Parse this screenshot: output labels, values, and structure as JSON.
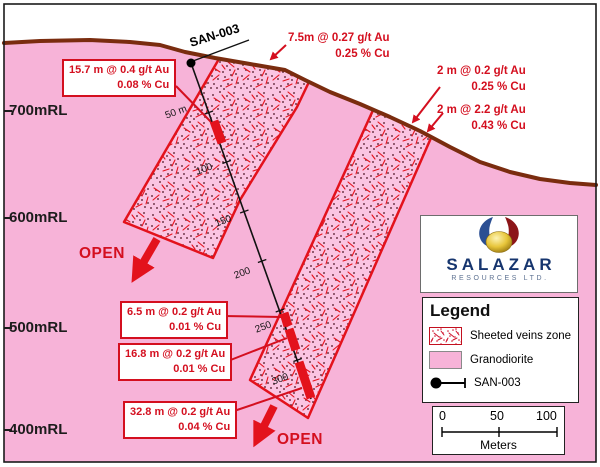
{
  "diagram": {
    "type": "geological cross-section",
    "drill_hole": {
      "name": "SAN-003"
    },
    "elevations": [
      "700mRL",
      "600mRL",
      "500mRL",
      "400mRL"
    ],
    "depth_marks": [
      "50 m",
      "100",
      "150",
      "200",
      "250",
      "300"
    ],
    "open_label": "OPEN",
    "assays": [
      {
        "line1": "15.7 m @ 0.4 g/t Au",
        "line2": "0.08 % Cu"
      },
      {
        "line1": "7.5m @ 0.27 g/t Au",
        "line2": "0.25 % Cu"
      },
      {
        "line1": "2 m @ 0.2 g/t Au",
        "line2": "0.25 % Cu"
      },
      {
        "line1": "2 m @ 2.2 g/t Au",
        "line2": "0.43 % Cu"
      },
      {
        "line1": "6.5 m @ 0.2 g/t Au",
        "line2": "0.01 % Cu"
      },
      {
        "line1": "16.8 m @ 0.2 g/t Au",
        "line2": "0.01 % Cu"
      },
      {
        "line1": "32.8 m @ 0.2 g/t Au",
        "line2": "0.04 % Cu"
      }
    ],
    "logo": {
      "title": "SALAZAR",
      "subtitle": "RESOURCES LTD."
    },
    "legend": {
      "title": "Legend",
      "items": [
        {
          "label": "Sheeted veins zone"
        },
        {
          "label": "Granodiorite"
        },
        {
          "label": "SAN-003"
        }
      ]
    },
    "scale_bar": {
      "ticks": [
        "0",
        "50",
        "100"
      ],
      "unit": "Meters"
    },
    "colors": {
      "granodiorite_pink": "#f7b3d8",
      "veins_zone_fill": "#fbc4e2",
      "vein_red": "#e3121c",
      "annotation_red": "#d40f1f",
      "surface_brown": "#7a2c0f",
      "logo_navy": "#16356e",
      "sky_white": "#ffffff"
    }
  }
}
